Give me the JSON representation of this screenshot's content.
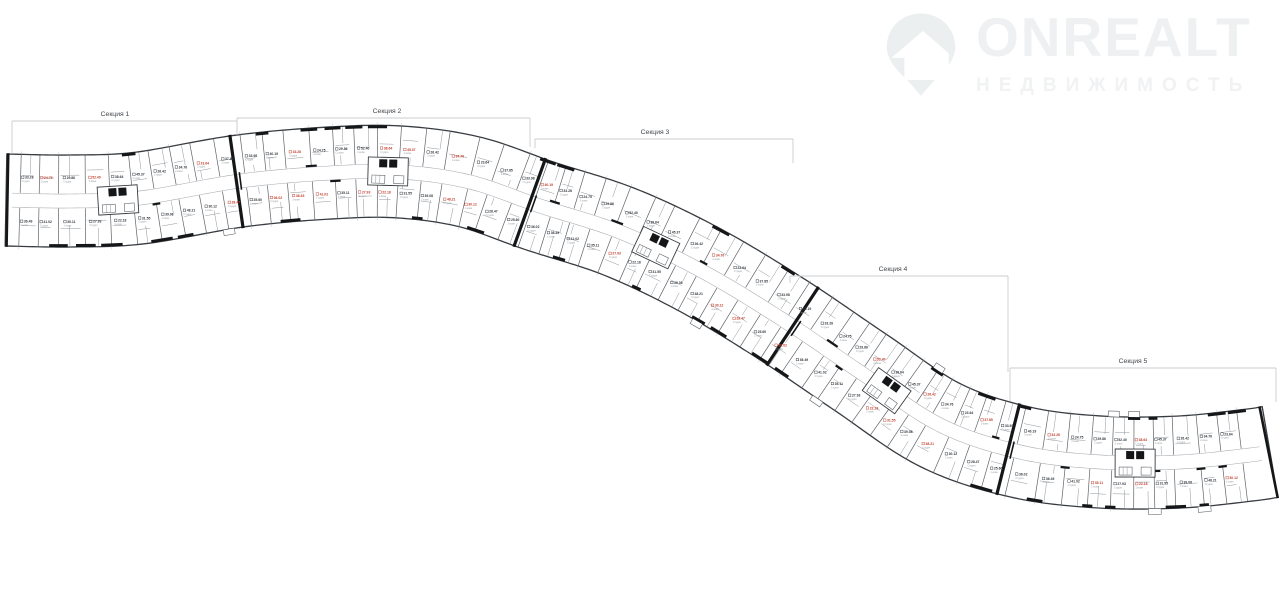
{
  "page": {
    "background": "#ffffff"
  },
  "logo": {
    "brand": "ONREALT",
    "subtitle": "НЕДВИЖИМОСТЬ",
    "color": "#eef0f1",
    "icon": "map-pin-house-icon"
  },
  "floorplan": {
    "colors": {
      "fill": "#ffffff",
      "outline": "#383c41",
      "wall_thin": "#5f646a",
      "wall_clutter": "#90969b",
      "wall_thick": "#141618",
      "corridor": "#a6abb0",
      "dim_tick": "#b7bbbe",
      "bracket_line": "#c9cccf",
      "bracket_text": "#43474c",
      "label_red": "#c2402f",
      "label_dark": "#343a40",
      "label_sub": "#9aa0a5"
    },
    "band": {
      "half_width": 46,
      "corridor_half_width": 7,
      "centerline": [
        [
          6,
          200
        ],
        [
          70,
          201
        ],
        [
          140,
          198
        ],
        [
          240,
          181
        ],
        [
          330,
          173
        ],
        [
          400,
          172
        ],
        [
          470,
          182
        ],
        [
          540,
          206
        ],
        [
          620,
          232
        ],
        [
          700,
          270
        ],
        [
          780,
          318
        ],
        [
          860,
          372
        ],
        [
          940,
          425
        ],
        [
          1020,
          452
        ],
        [
          1100,
          462
        ],
        [
          1180,
          462
        ],
        [
          1250,
          455
        ],
        [
          1270,
          452
        ]
      ]
    },
    "sections": [
      {
        "label": "Секция 1",
        "x1": 12,
        "x2": 237,
        "line_y": 121,
        "label_x": 115,
        "label_y": 116,
        "tick_left": 32,
        "tick_right": 14
      },
      {
        "label": "Секция 2",
        "x1": 237,
        "x2": 530,
        "line_y": 118,
        "label_x": 387,
        "label_y": 113,
        "tick_left": 14,
        "tick_right": 29
      },
      {
        "label": "Секция 3",
        "x1": 535,
        "x2": 793,
        "line_y": 139,
        "label_x": 655,
        "label_y": 134,
        "tick_left": 9,
        "tick_right": 24
      },
      {
        "label": "Секция 4",
        "x1": 790,
        "x2": 1008,
        "line_y": 276,
        "label_x": 893,
        "label_y": 271,
        "tick_left": 7,
        "tick_right": 96
      },
      {
        "label": "Секция 5",
        "x1": 1010,
        "x2": 1276,
        "line_y": 368,
        "label_x": 1133,
        "label_y": 363,
        "tick_left": 33,
        "tick_right": 34
      }
    ],
    "boundaries_x": [
      237,
      530,
      793,
      1008
    ],
    "cores_x": [
      118,
      388,
      655,
      886,
      1135
    ],
    "unit_spacing": 23,
    "unit_area_samples": [
      "33.28",
      "36.49",
      "24.75",
      "41.02",
      "29.86",
      "35.11",
      "52.40",
      "27.93",
      "38.64",
      "22.18",
      "45.37",
      "31.55",
      "26.42",
      "39.08",
      "34.76",
      "48.21",
      "23.64",
      "30.12",
      "37.85",
      "28.47",
      "33.98",
      "25.60",
      "40.19",
      "36.02"
    ],
    "unit_type_samples": [
      "Студия",
      "1-комн",
      "2-комн",
      "Студия"
    ]
  }
}
